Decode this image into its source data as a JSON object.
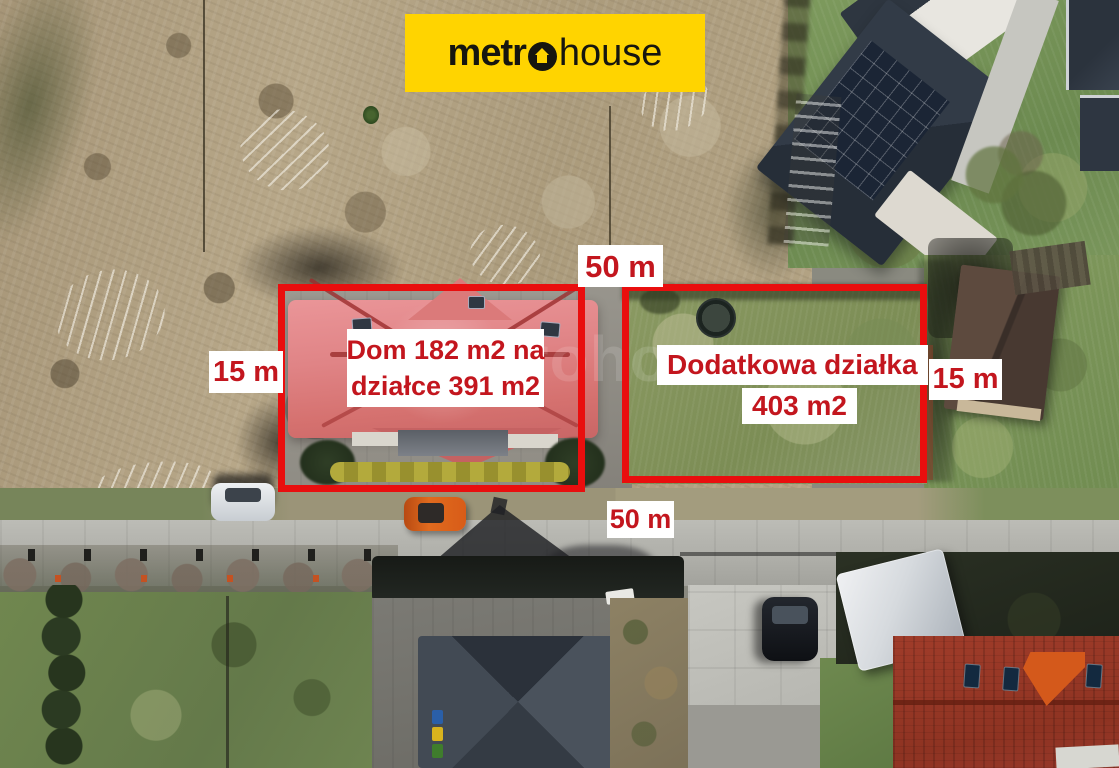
{
  "logo": {
    "bg_color": "#ffd400",
    "text_color": "#16160f",
    "part_metr": "metr",
    "part_house": "house",
    "o_icon": "house-in-circle"
  },
  "annotations": {
    "outline_color": "#e90e0e",
    "label_text_color": "#c3161e",
    "label_bg_color": "#ffffff",
    "top_length": "50 m",
    "bottom_length": "50 m",
    "left_width": "15 m",
    "right_width": "15 m",
    "house_plot_line1": "Dom 182 m2 na",
    "house_plot_line2": "działce 391 m2",
    "extra_plot_line1": "Dodatkowa działka",
    "extra_plot_line2": "403 m2"
  },
  "watermark": "metrohouse",
  "scene_colors": {
    "scrub_field": "#b3a384",
    "lawn_green": "#7c8d55",
    "subject_roof": "#e08486",
    "modern_roof": "#2b333d",
    "terracotta_roof": "#9b392a",
    "road_concrete": "#b2b2ac"
  }
}
